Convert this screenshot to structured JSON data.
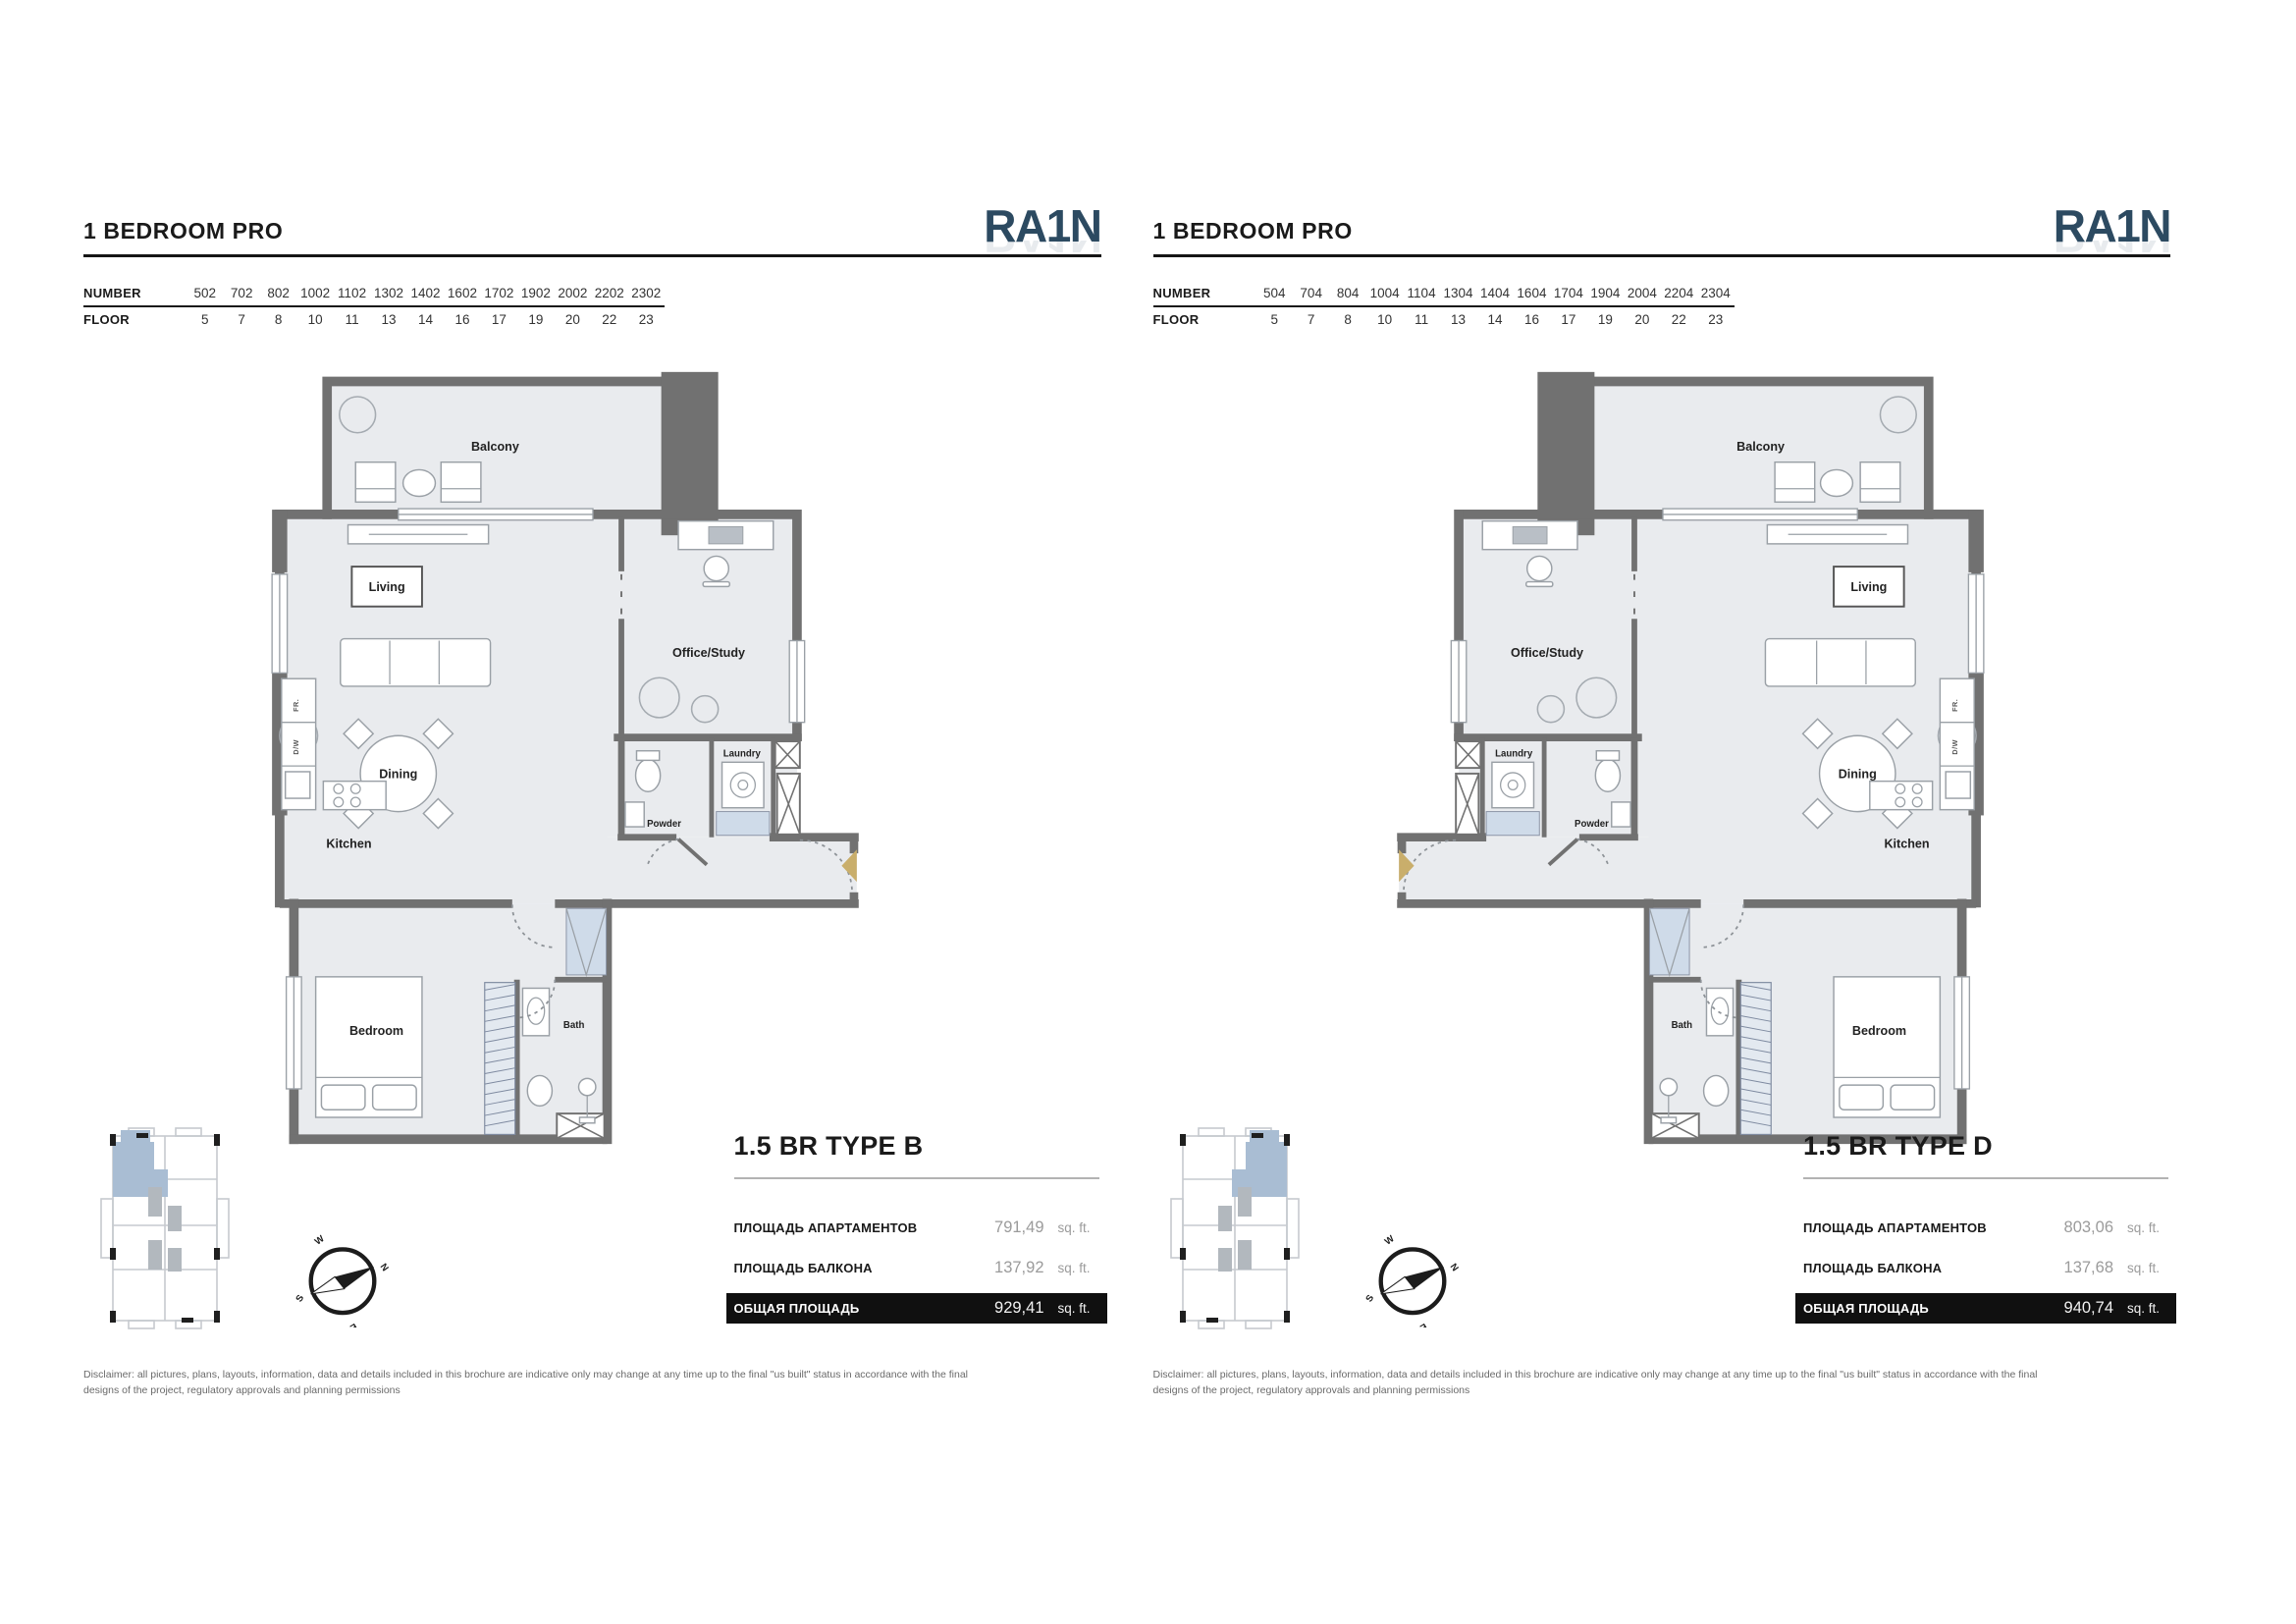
{
  "brand": {
    "logo_text": "RA1N",
    "logo_color": "#2c4a61"
  },
  "shared": {
    "room_labels": {
      "balcony": "Balcony",
      "living": "Living",
      "office": "Office/Study",
      "dining": "Dining",
      "kitchen": "Kitchen",
      "powder": "Powder",
      "laundry": "Laundry",
      "bedroom": "Bedroom",
      "bath": "Bath",
      "fridge": "FR.",
      "dishwasher": "D/W"
    },
    "compass": {
      "north": "N",
      "east": "E",
      "south": "S",
      "west": "W"
    },
    "disclaimer": "Disclaimer: all pictures, plans, layouts, information, data and details included in this brochure are indicative only may change at any time up to the final \"us built\" status in accordance with the final designs of the project, regulatory approvals and planning permissions"
  },
  "left_page": {
    "title": "1 BEDROOM PRO",
    "unit_table": {
      "number_label": "NUMBER",
      "floor_label": "FLOOR",
      "numbers": [
        "502",
        "702",
        "802",
        "1002",
        "1102",
        "1302",
        "1402",
        "1602",
        "1702",
        "1902",
        "2002",
        "2202",
        "2302"
      ],
      "floors": [
        "5",
        "7",
        "8",
        "10",
        "11",
        "13",
        "14",
        "16",
        "17",
        "19",
        "20",
        "22",
        "23"
      ]
    },
    "type_name": "1.5 BR TYPE B",
    "areas": [
      {
        "label": "ПЛОЩАДЬ АПАРТАМЕНТОВ",
        "value": "791,49",
        "unit": "sq. ft."
      },
      {
        "label": "ПЛОЩАДЬ БАЛКОНА",
        "value": "137,92",
        "unit": "sq. ft."
      },
      {
        "label": "ОБЩАЯ ПЛОЩАДЬ",
        "value": "929,41",
        "unit": "sq. ft.",
        "highlight": true
      }
    ]
  },
  "right_page": {
    "title": "1 BEDROOM PRO",
    "unit_table": {
      "number_label": "NUMBER",
      "floor_label": "FLOOR",
      "numbers": [
        "504",
        "704",
        "804",
        "1004",
        "1104",
        "1304",
        "1404",
        "1604",
        "1704",
        "1904",
        "2004",
        "2204",
        "2304"
      ],
      "floors": [
        "5",
        "7",
        "8",
        "10",
        "11",
        "13",
        "14",
        "16",
        "17",
        "19",
        "20",
        "22",
        "23"
      ]
    },
    "type_name": "1.5 BR TYPE D",
    "areas": [
      {
        "label": "ПЛОЩАДЬ АПАРТАМЕНТОВ",
        "value": "803,06",
        "unit": "sq. ft."
      },
      {
        "label": "ПЛОЩАДЬ БАЛКОНА",
        "value": "137,68",
        "unit": "sq. ft."
      },
      {
        "label": "ОБЩАЯ ПЛОЩАДЬ",
        "value": "940,74",
        "unit": "sq. ft.",
        "highlight": true
      }
    ]
  }
}
